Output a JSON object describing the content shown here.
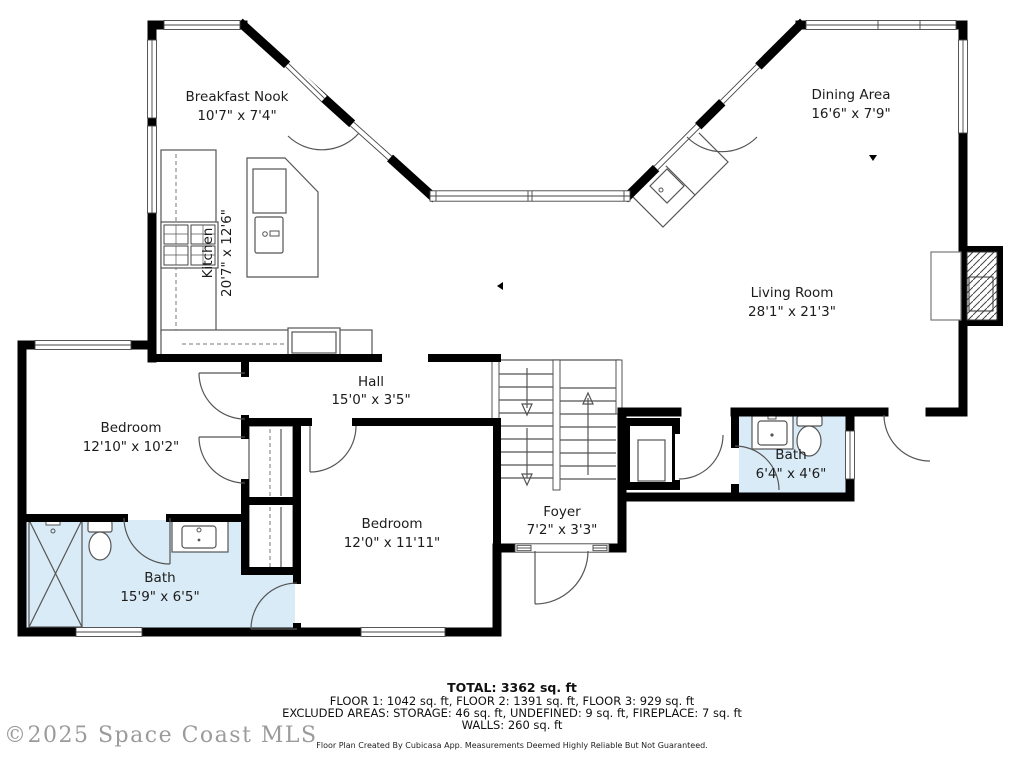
{
  "rooms": {
    "breakfast_nook": {
      "name": "Breakfast Nook",
      "dims": "10'7\" x 7'4\""
    },
    "dining_area": {
      "name": "Dining Area",
      "dims": "16'6\" x 7'9\""
    },
    "kitchen": {
      "name": "Kitchen",
      "dims": "20'7\" x 12'6\""
    },
    "living_room": {
      "name": "Living Room",
      "dims": "28'1\" x 21'3\""
    },
    "hall": {
      "name": "Hall",
      "dims": "15'0\" x 3'5\""
    },
    "bedroom_left": {
      "name": "Bedroom",
      "dims": "12'10\" x 10'2\""
    },
    "bedroom_lower": {
      "name": "Bedroom",
      "dims": "12'0\" x 11'11\""
    },
    "foyer": {
      "name": "Foyer",
      "dims": "7'2\" x 3'3\""
    },
    "bath_small": {
      "name": "Bath",
      "dims": "6'4\" x 4'6\""
    },
    "bath_large": {
      "name": "Bath",
      "dims": "15'9\" x 6'5\""
    }
  },
  "footer": {
    "total": "TOTAL: 3362 sq. ft",
    "floors": "FLOOR 1: 1042 sq. ft, FLOOR 2: 1391 sq. ft, FLOOR 3: 929 sq. ft",
    "excluded": "EXCLUDED AREAS: STORAGE: 46 sq. ft, UNDEFINED: 9 sq. ft, FIREPLACE: 7 sq. ft",
    "walls": "WALLS: 260 sq. ft",
    "credit": "Floor Plan Created By Cubicasa App. Measurements Deemed Highly Reliable But Not Guaranteed."
  },
  "watermark": "©2025 Space Coast MLS",
  "colors": {
    "bath_fill": "#d9ebf7",
    "wall": "#000000"
  }
}
